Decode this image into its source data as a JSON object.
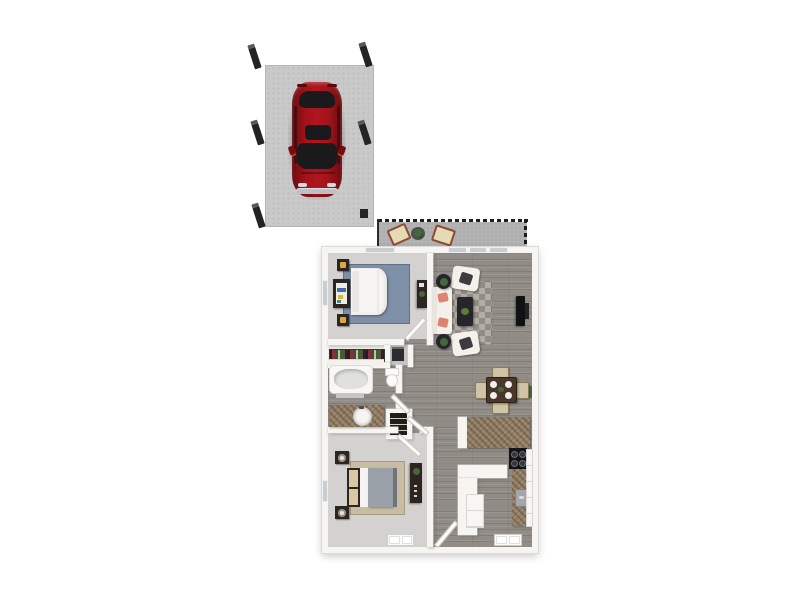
{
  "image": {
    "kind": "3d-floor-plan-render",
    "label": "Two-bedroom one-bath apartment floor plan with patio and detached carport",
    "background": "#ffffff"
  },
  "palette": {
    "carport_pad": "#c9c9c9",
    "post_dark": "#232327",
    "car_red": "#9c1016",
    "car_glass": "#1a1a1d",
    "car_bumper": "#bfbfc3",
    "patio_floor": "#b4b4b4",
    "railing": "#1d1d1f",
    "chair_frame": "#8d4a38",
    "chair_cushion": "#e6dab4",
    "plant_green": "#44683c",
    "wall_white": "#f6f5f2",
    "wood_floor": "#918c86",
    "carpet": "#d3d2d0",
    "rug_blue": "#7e90a8",
    "rug_tan": "#c8bda2",
    "furniture_dark": "#2e2520",
    "lamp_gold": "#d9a93c",
    "lamp_cream": "#eae4d4",
    "bed_white": "#f6f5f3",
    "bed2_duvet": "#9aa0a8",
    "headboard_tan": "#d6c9a4",
    "sofa_white": "#f3f1ec",
    "pillow_coral": "#df8370",
    "pillow_dark": "#3c3c40",
    "coffee_table": "#26262a",
    "tv_black": "#111113",
    "dining_table": "#4a372a",
    "dining_chair": "#cfc4a6",
    "granite": "#937e64",
    "steel": "#a6a6aa",
    "stove_black": "#141416",
    "tub_inner": "#e0e0df",
    "closet_gray": "#c3c3c3",
    "window_glass": "#c9ced2"
  },
  "carport": {
    "label": "Carport",
    "posts": 6,
    "car": {
      "label": "Red car, top view"
    }
  },
  "patio": {
    "label": "Patio",
    "chairs": 2,
    "planter_tables": 1,
    "railing": "dashed black"
  },
  "apartment": {
    "label": "Apartment",
    "rooms": {
      "bedroom1": {
        "label": "Bedroom 1",
        "furniture": [
          "bed",
          "nightstand",
          "nightstand",
          "storage-console",
          "dresser",
          "blue-area-rug",
          "closet-with-hanging-clothes"
        ]
      },
      "living": {
        "label": "Living room",
        "furniture": [
          "sofa",
          "armchair",
          "armchair",
          "coffee-table",
          "side-table",
          "side-table",
          "checkered-area-rug",
          "wall-mounted-tv"
        ]
      },
      "dining": {
        "label": "Dining area",
        "furniture": [
          "dining-table",
          "dining-chair",
          "dining-chair",
          "dining-chair",
          "dining-chair"
        ]
      },
      "kitchen": {
        "label": "Kitchen",
        "furniture": [
          "breakfast-bar",
          "range",
          "sink",
          "counter",
          "cabinets",
          "bar-counter"
        ]
      },
      "bath": {
        "label": "Bathroom",
        "furniture": [
          "bathtub",
          "toilet",
          "vanity-with-sink"
        ]
      },
      "bedroom2": {
        "label": "Bedroom 2",
        "furniture": [
          "bed",
          "nightstand",
          "nightstand",
          "dresser",
          "tan-area-rug"
        ]
      },
      "hall": {
        "label": "Hallway"
      },
      "linen": {
        "label": "Linen closet"
      },
      "utility": {
        "label": "Utility closet"
      },
      "entry": {
        "label": "Entry"
      }
    }
  }
}
